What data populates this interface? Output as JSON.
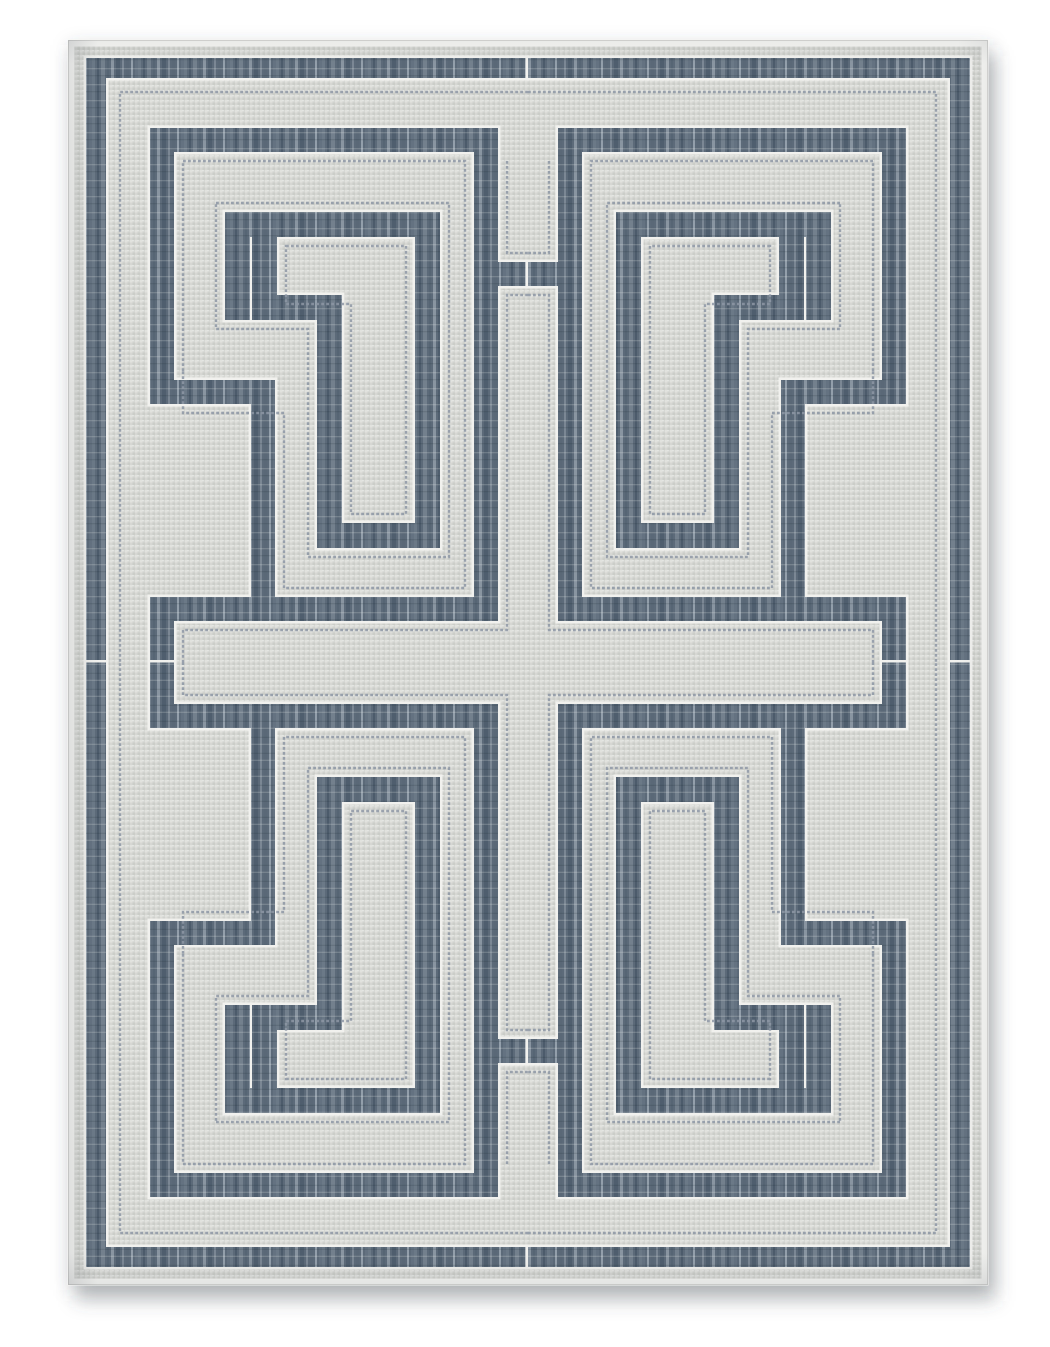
{
  "scene": {
    "description": "Product photo of a rectangular flat-weave area rug with a gray-blue Greek key fretwork pattern on a light gray ground, on a white background",
    "background_color": "#ffffff",
    "canvas": {
      "width": 1050,
      "height": 1347
    }
  },
  "colors": {
    "photo_bg": "#ffffff",
    "field_base": "#d6d7d3",
    "field_dot_light": "#e1e2de",
    "field_dot_dark": "#cbcdc8",
    "band_base": "#5c6a79",
    "band_streaks": [
      "#6b7987",
      "#4c5b6b",
      "#73808d",
      "#566574",
      "#8995a1",
      "#4f5e6e",
      "#7b8794",
      "#5a6877",
      "#939fab",
      "#647281"
    ],
    "band_weft_light": "rgba(236,238,236,0.20)",
    "band_weft_dark": "rgba(22,32,44,0.14)",
    "pinline": "#f1f1ee",
    "pinstripe": "#8d97a4",
    "selvage": "#f7f7f4",
    "edge_hairline": "#d9d9d6",
    "shadow_soft": "rgba(70,75,85,0.30)",
    "shadow_tight": "rgba(70,75,85,0.22)",
    "edge_shade": "rgba(55,62,74,1)"
  },
  "rug": {
    "x": 68,
    "y": 40,
    "width": 920,
    "height": 1245,
    "mirror_x_sum": 1056,
    "mirror_y_sum": 1325
  },
  "quadrants": [
    {
      "name": "upper-left",
      "transform": ""
    },
    {
      "name": "upper-right",
      "transform": "matrix(-1 0 0 1 1056 0)"
    },
    {
      "name": "lower-left",
      "transform": "matrix(1 0 0 -1 0 1325)"
    },
    {
      "name": "lower-right",
      "transform": "matrix(-1 0 0 -1 1056 1325)"
    }
  ],
  "band_names": [
    "outer-border-band-top",
    "outer-border-band-side",
    "frame-band-top",
    "frame-band-side",
    "frame-jog",
    "frame-drop",
    "center-column-band",
    "center-bridge",
    "cross-band-edge",
    "cross-band-end-cap"
  ],
  "border_rects": [
    [
      86,
      58,
      442,
      20
    ],
    [
      86,
      58,
      20,
      604.5
    ]
  ],
  "fret_rects": [
    [
      150,
      128,
      348,
      24
    ],
    [
      150,
      128,
      24,
      276
    ],
    [
      150,
      380,
      125,
      24
    ],
    [
      251,
      380,
      24,
      241
    ],
    [
      474,
      128,
      24,
      493
    ],
    [
      474,
      262,
      54,
      24
    ],
    [
      150,
      597,
      348,
      24
    ],
    [
      150,
      597,
      24,
      65.5
    ]
  ],
  "motif_leg_names": [
    "top-bar",
    "outer-stub",
    "descender",
    "hook-bottom",
    "hook-riser",
    "hook-top",
    "inner-stub"
  ],
  "motif_rects": [
    [
      225,
      212,
      215,
      25
    ],
    [
      225,
      212,
      25,
      108
    ],
    [
      415,
      212,
      25,
      336
    ],
    [
      317,
      523,
      123,
      25
    ],
    [
      317,
      295,
      25,
      253
    ],
    [
      252,
      295,
      90,
      25
    ],
    [
      252,
      237,
      25,
      83
    ]
  ],
  "pinstripes": [
    "M528,92 H120 V662.5",
    "M183,371 V161 H465 V588 H284 V413 H183 Z",
    "M216,203 H449 V557 H308 V329 H216 Z",
    "M286,246 H406 V514 H351 V304 H286 Z",
    "M528,295 H507 V630 H183 V662.5",
    "M507,161 V253 H528"
  ],
  "pinstripe_style": {
    "width": 2.4,
    "dash": "2.8 2.2",
    "opacity": 0.85
  },
  "edging_dilation": 2.5,
  "shading": [
    {
      "name": "left-edge-shade",
      "x": 68,
      "y": 40,
      "w": 30,
      "h": 1245,
      "dir": "to-right",
      "alpha": 0.13
    },
    {
      "name": "top-edge-shade",
      "x": 68,
      "y": 40,
      "w": 920,
      "h": 24,
      "dir": "to-bottom",
      "alpha": 0.07
    },
    {
      "name": "right-edge-shade",
      "x": 958,
      "y": 40,
      "w": 30,
      "h": 1245,
      "dir": "to-left",
      "alpha": 0.06
    },
    {
      "name": "bottom-edge-shade",
      "x": 68,
      "y": 1253,
      "w": 920,
      "h": 32,
      "dir": "to-top",
      "alpha": 0.1
    }
  ],
  "drop_shadows": [
    {
      "dx": 8,
      "dy": 16,
      "blur": 10,
      "alpha": 0.3
    },
    {
      "dx": 2,
      "dy": 5,
      "blur": 4,
      "alpha": 0.22
    }
  ]
}
